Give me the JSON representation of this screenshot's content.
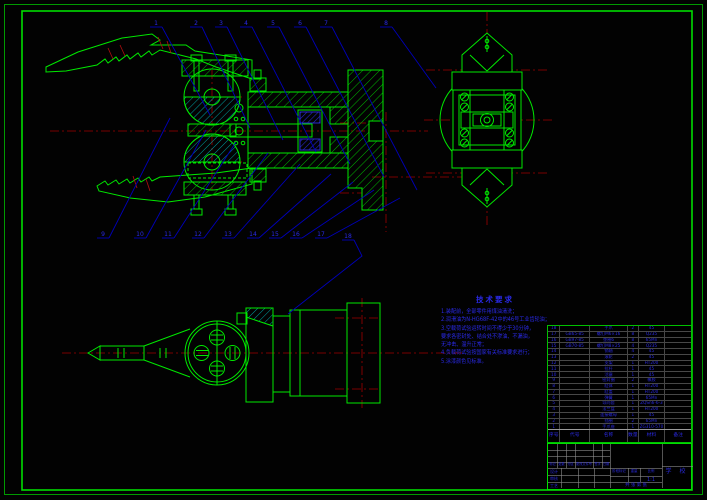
{
  "drawing": {
    "tech_requirements": {
      "title": "技术要求",
      "lines": [
        "1.装配前，全部零件用煤油清洗；",
        "2.润滑油为N-HG68F-42中的46号工业齿轮油；",
        "3.空载荷试验运转时间不得少于30分钟，",
        "要求各密封处、结合处不渗油、不漏油，",
        "无冲击、温升正常；",
        "4.负载荷试验按国家有关标准要求进行；",
        "5.涂漆颜色见标准。"
      ]
    },
    "balloons": {
      "top": [
        "1",
        "2",
        "3",
        "4",
        "5",
        "6",
        "7",
        "8"
      ],
      "bottom": [
        "9",
        "10",
        "11",
        "12",
        "13",
        "14",
        "15",
        "16",
        "17",
        "18"
      ]
    },
    "bom": {
      "headers": [
        "序号",
        "代号",
        "名称",
        "数量",
        "材料",
        "备注"
      ],
      "rows": [
        [
          "18",
          "",
          "手爪",
          "2",
          "45",
          ""
        ],
        [
          "17",
          "GB65-85",
          "螺钉M6×16",
          "8",
          "Q235",
          ""
        ],
        [
          "16",
          "GB97-85",
          "垫圈6",
          "8",
          "65Mn",
          ""
        ],
        [
          "15",
          "GB70-85",
          "螺钉M8×25",
          "4",
          "Q235",
          ""
        ],
        [
          "14",
          "",
          "销轴",
          "4",
          "45",
          ""
        ],
        [
          "13",
          "",
          "滚轮",
          "2",
          "45",
          ""
        ],
        [
          "12",
          "",
          "支架",
          "1",
          "HT200",
          ""
        ],
        [
          "11",
          "",
          "拉杆",
          "1",
          "45",
          ""
        ],
        [
          "10",
          "",
          "活塞",
          "1",
          "45",
          ""
        ],
        [
          "9",
          "",
          "密封圈",
          "2",
          "橡胶",
          ""
        ],
        [
          "8",
          "",
          "缸体",
          "1",
          "HT200",
          ""
        ],
        [
          "7",
          "",
          "缸盖",
          "1",
          "HT200",
          ""
        ],
        [
          "6",
          "",
          "弹簧",
          "1",
          "65Mn",
          ""
        ],
        [
          "5",
          "",
          "导向套",
          "1",
          "ZQSn6-6-3",
          ""
        ],
        [
          "4",
          "",
          "法兰盘",
          "1",
          "HT200",
          ""
        ],
        [
          "3",
          "",
          "连接螺母",
          "1",
          "45",
          ""
        ],
        [
          "2",
          "",
          "挡圈",
          "2",
          "65Mn",
          ""
        ],
        [
          "1",
          "",
          "手爪座",
          "1",
          "ZG310-570",
          ""
        ]
      ]
    },
    "title_block": {
      "revision_labels": [
        "标记",
        "处数",
        "分区",
        "更改文件号",
        "签字",
        "日期"
      ],
      "sign_rows": [
        "设计",
        "审核",
        "工艺"
      ],
      "stage_label": "阶段标记",
      "weight_label": "重量",
      "scale_label": "比例",
      "scale_value": "1:1",
      "sheet_label": "共 张 第 张",
      "org": "学 校"
    },
    "colors": {
      "line_green": "#00e800",
      "hatch_cyan": "#00a0a0",
      "centerline_red": "#a00000",
      "leader_blue": "#0000b8",
      "text_blue": "#2a2ae0"
    }
  }
}
